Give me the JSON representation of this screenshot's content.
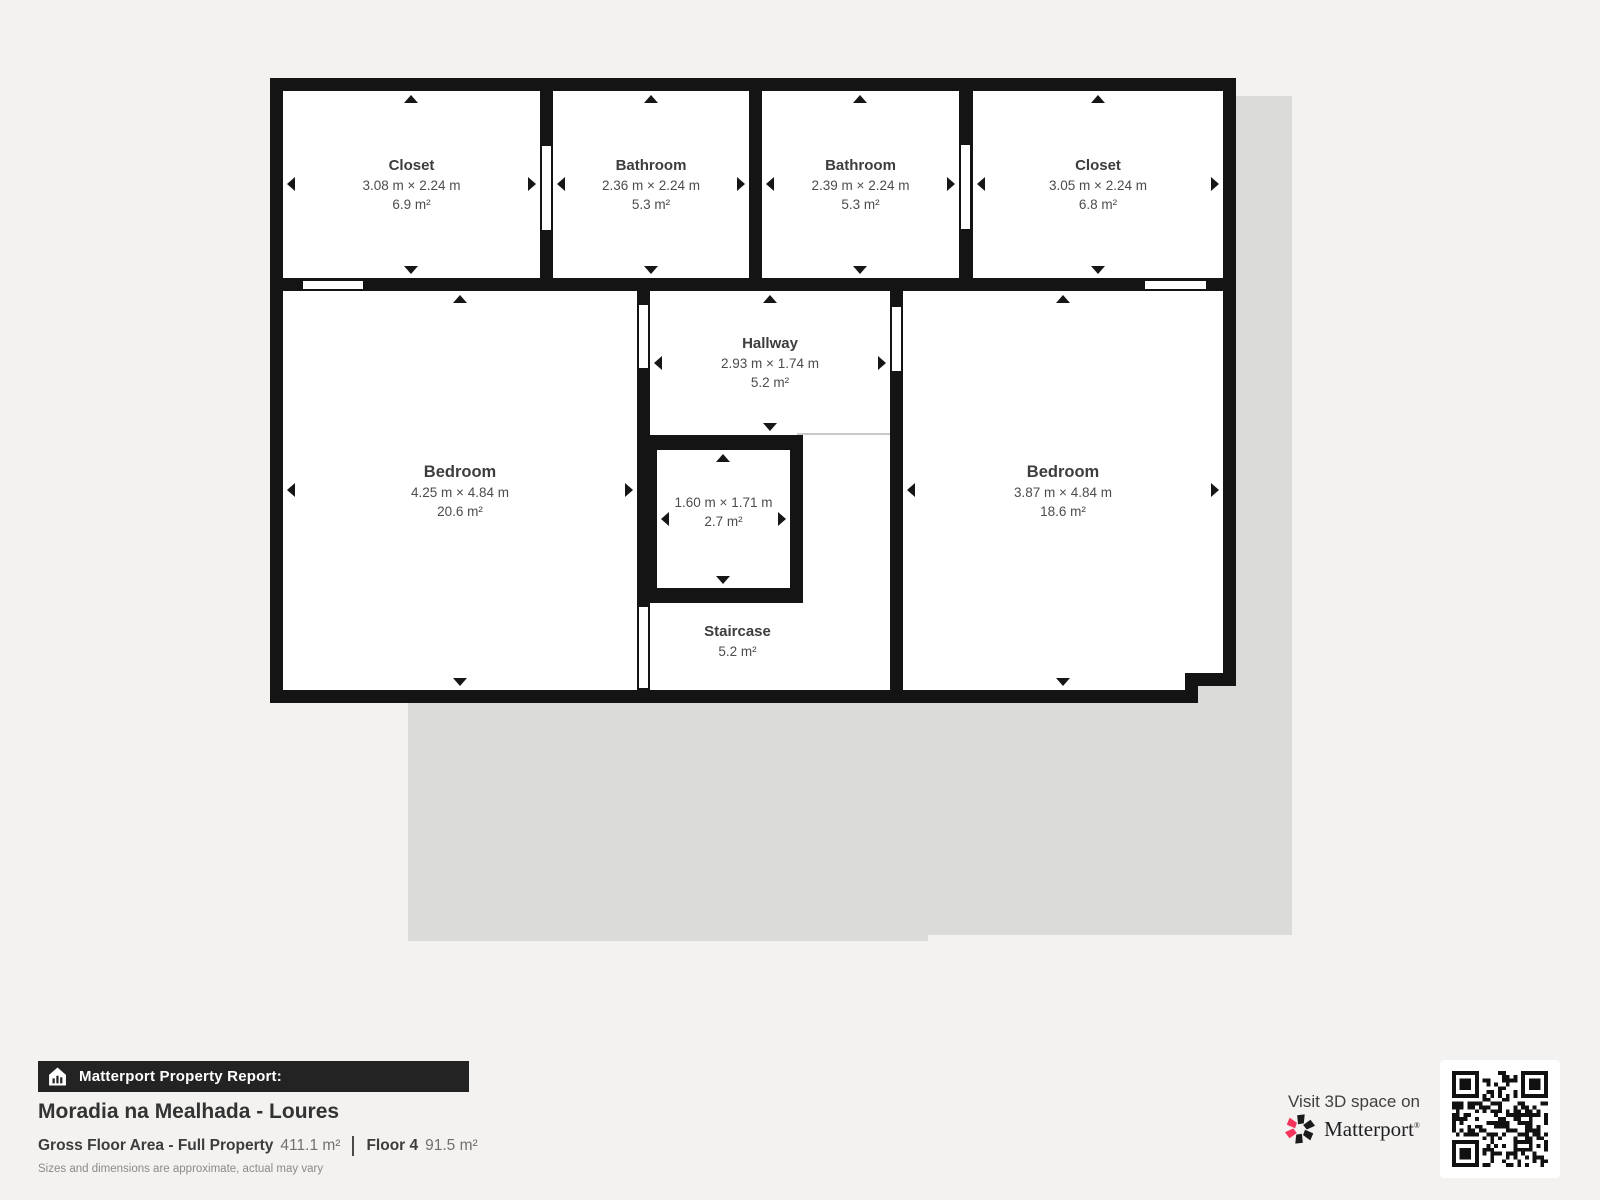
{
  "floor_plan": {
    "rooms": [
      {
        "id": "closet-1",
        "name": "Closet",
        "dimensions": "3.08 m × 2.24 m",
        "area": "6.9 m²"
      },
      {
        "id": "bathroom-1",
        "name": "Bathroom",
        "dimensions": "2.36 m × 2.24 m",
        "area": "5.3 m²"
      },
      {
        "id": "bathroom-2",
        "name": "Bathroom",
        "dimensions": "2.39 m × 2.24 m",
        "area": "5.3 m²"
      },
      {
        "id": "closet-2",
        "name": "Closet",
        "dimensions": "3.05 m × 2.24 m",
        "area": "6.8 m²"
      },
      {
        "id": "bedroom-left",
        "name": "Bedroom",
        "dimensions": "4.25 m × 4.84 m",
        "area": "20.6 m²"
      },
      {
        "id": "hallway",
        "name": "Hallway",
        "dimensions": "2.93 m × 1.74 m",
        "area": "5.2 m²"
      },
      {
        "id": "small-room",
        "name": "",
        "dimensions": "1.60 m × 1.71 m",
        "area": "2.7 m²"
      },
      {
        "id": "bedroom-right",
        "name": "Bedroom",
        "dimensions": "3.87 m × 4.84 m",
        "area": "18.6 m²"
      },
      {
        "id": "staircase",
        "name": "Staircase",
        "dimensions": "",
        "area": "5.2 m²"
      }
    ]
  },
  "report": {
    "banner": "Matterport Property Report:",
    "property_name": "Moradia na Mealhada - Loures",
    "gross_floor_label": "Gross Floor Area - Full Property",
    "gross_floor_value": "411.1 m²",
    "floor_label": "Floor 4",
    "floor_value": "91.5 m²",
    "disclaimer": "Sizes and dimensions are approximate, actual may vary"
  },
  "promo": {
    "visit_text": "Visit 3D space on",
    "brand": "Matterport",
    "brand_mark": "®"
  },
  "colors": {
    "background": "#f3f2f0",
    "lower_floor_shadow": "#dbdbda",
    "wall": "#141414",
    "brand_pink": "#f4345c",
    "brand_black": "#1b1b1b"
  }
}
